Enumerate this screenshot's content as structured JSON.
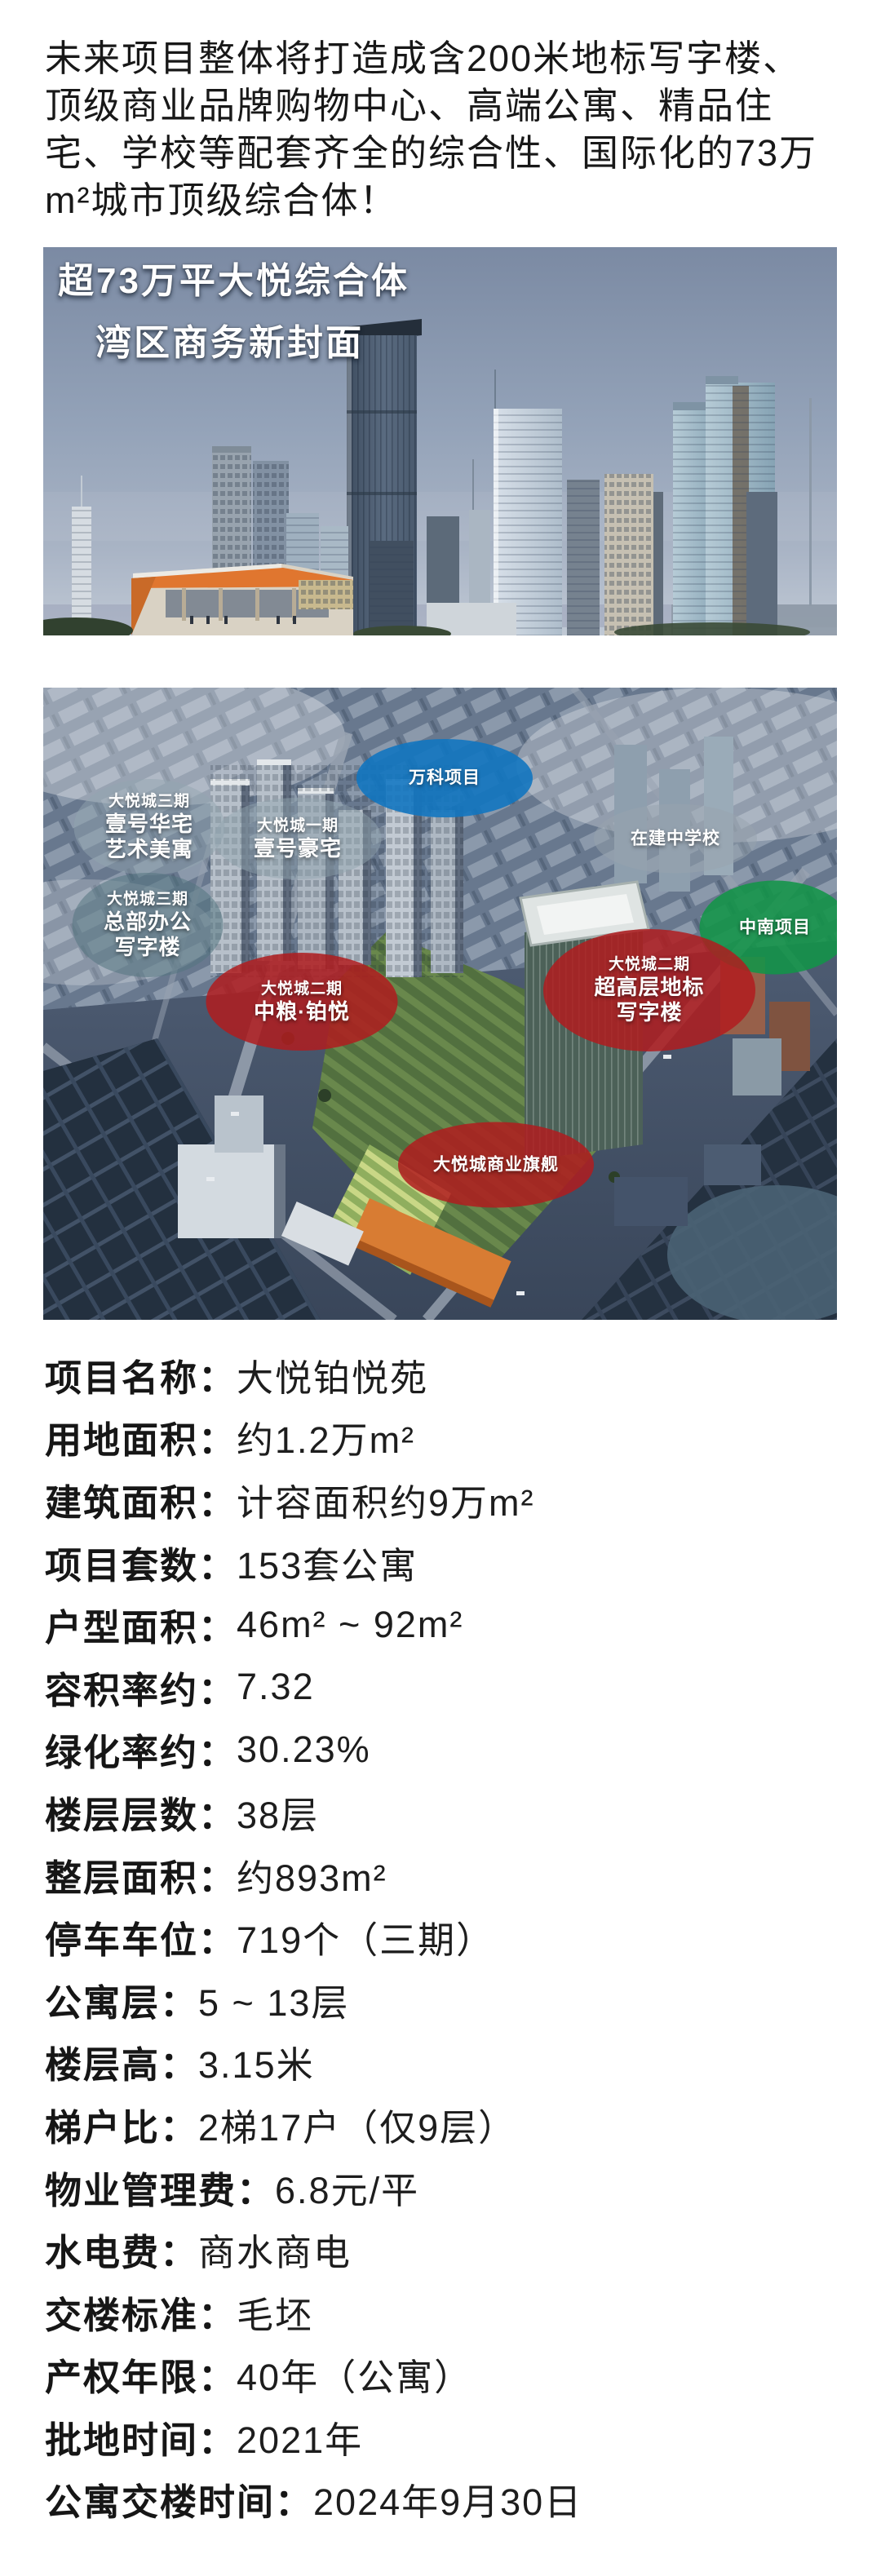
{
  "intro": {
    "lines": [
      "未来项目整体将打造成含200米地标写字楼、",
      "顶级商业品牌购物中心、高端公寓、精品住",
      "宅、学校等配套齐全的综合性、国际化的73万",
      "m²城市顶级综合体！"
    ]
  },
  "hero": {
    "title_line1": "超73万平大悦综合体",
    "title_line2": "湾区商务新封面"
  },
  "aerial": {
    "labels": {
      "wanke": {
        "text": "万科项目"
      },
      "huazhai": {
        "tag": "大悦城三期",
        "line1": "壹号华宅",
        "line2": "艺术美寓"
      },
      "haozhai": {
        "tag": "大悦城一期",
        "line1": "壹号豪宅"
      },
      "school": {
        "text": "在建中学校"
      },
      "hq": {
        "tag": "大悦城三期",
        "line1": "总部办公",
        "line2": "写字楼"
      },
      "zhongnan": {
        "text": "中南项目"
      },
      "boyue": {
        "tag": "大悦城二期",
        "line1": "中粮·铂悦"
      },
      "landmark": {
        "tag": "大悦城二期",
        "line1": "超高层地标",
        "line2": "写字楼"
      },
      "flagship": {
        "text": "大悦城商业旗舰"
      }
    }
  },
  "specs": [
    {
      "label": "项目名称：",
      "value": "大悦铂悦苑"
    },
    {
      "label": "用地面积：",
      "value": "约1.2万m²"
    },
    {
      "label": "建筑面积：",
      "value": "计容面积约9万m²"
    },
    {
      "label": "项目套数：",
      "value": "153套公寓"
    },
    {
      "label": "户型面积：",
      "value": "46m² ~ 92m²"
    },
    {
      "label": "容积率约：",
      "value": "7.32"
    },
    {
      "label": "绿化率约：",
      "value": "30.23%"
    },
    {
      "label": "楼层层数：",
      "value": "38层"
    },
    {
      "label": "整层面积：",
      "value": "约893m²"
    },
    {
      "label": "停车车位：",
      "value": "719个（三期）"
    },
    {
      "label": "公寓层：",
      "value": "5 ~ 13层"
    },
    {
      "label": "楼层高：",
      "value": "3.15米"
    },
    {
      "label": "梯户比：",
      "value": "2梯17户（仅9层）"
    },
    {
      "label": "物业管理费：",
      "value": "6.8元/平"
    },
    {
      "label": "水电费：",
      "value": "商水商电"
    },
    {
      "label": "交楼标准：",
      "value": "毛坯"
    },
    {
      "label": "产权年限：",
      "value": "40年（公寓）"
    },
    {
      "label": "批地时间：",
      "value": "2021年"
    },
    {
      "label": "公寓交楼时间：",
      "value": "2024年9月30日"
    }
  ],
  "colors": {
    "ellipse_red": "#b01c1e",
    "ellipse_blue": "#1276c0",
    "ellipse_green": "#129448",
    "ellipse_gray": "#92a6b0",
    "accent_orange": "#e0762f",
    "text": "#1a1a1a"
  }
}
